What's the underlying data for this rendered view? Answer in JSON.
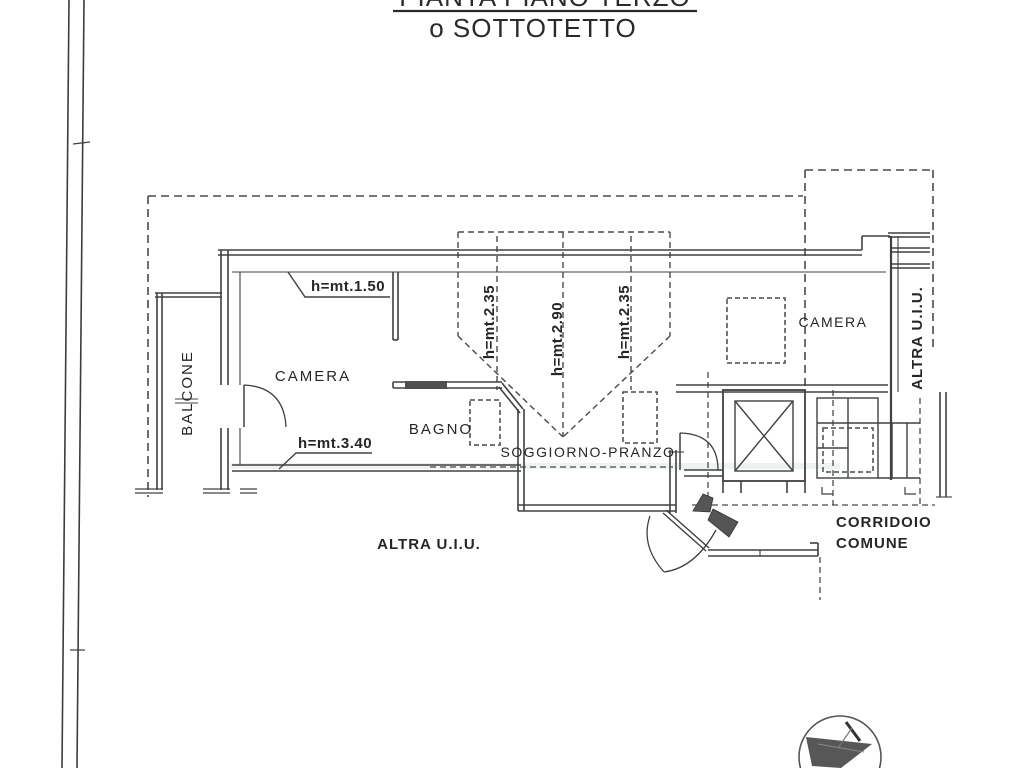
{
  "title": {
    "line1": "PIANTA PIANO TERZO",
    "line2": "o SOTTOTETTO"
  },
  "rooms": {
    "balcone": "BALCONE",
    "camera_left": "CAMERA",
    "bagno": "BAGNO",
    "soggiorno": "SOGGIORNO-PRANZO",
    "camera_right": "CAMERA",
    "altra_uiu_right": "ALTRA U.I.U.",
    "altra_uiu_bottom": "ALTRA U.I.U.",
    "corridoio_line1": "CORRIDOIO",
    "corridoio_line2": "COMUNE"
  },
  "annotations": {
    "h_150": "h=mt.1.50",
    "h_340": "h=mt.3.40",
    "h_235_left": "h=mt.2.35",
    "h_290": "h=mt.2.90",
    "h_235_right": "h=mt.2.35"
  },
  "colors": {
    "wall_line": "#404040",
    "dashed_line": "#4a4a4a",
    "text": "#262626",
    "background": "#ffffff",
    "stamp": "#3a3a3a"
  }
}
